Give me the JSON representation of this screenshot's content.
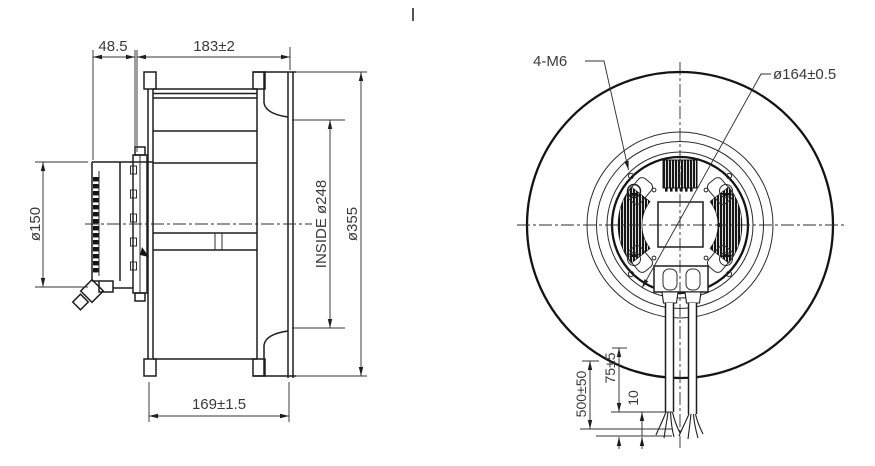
{
  "meta": {
    "background_color": "#ffffff",
    "line_color": "#1e1e1e",
    "text_color": "#3a3a3a",
    "drawing_type": "centrifugal-fan-engineering-drawing"
  },
  "side_view": {
    "dims": {
      "motor_length": "48.5",
      "impeller_width": "183±2",
      "motor_diameter": "ø150",
      "inside_diameter": "INSIDE ø248",
      "outer_diameter": "ø355",
      "base_depth": "169±1.5"
    }
  },
  "front_view": {
    "labels": {
      "mounting_holes": "4-M6",
      "pitch_circle": "ø164±0.5",
      "cable_length": "500±50",
      "cable_strip": "75±5",
      "cable_tip": "10"
    }
  }
}
